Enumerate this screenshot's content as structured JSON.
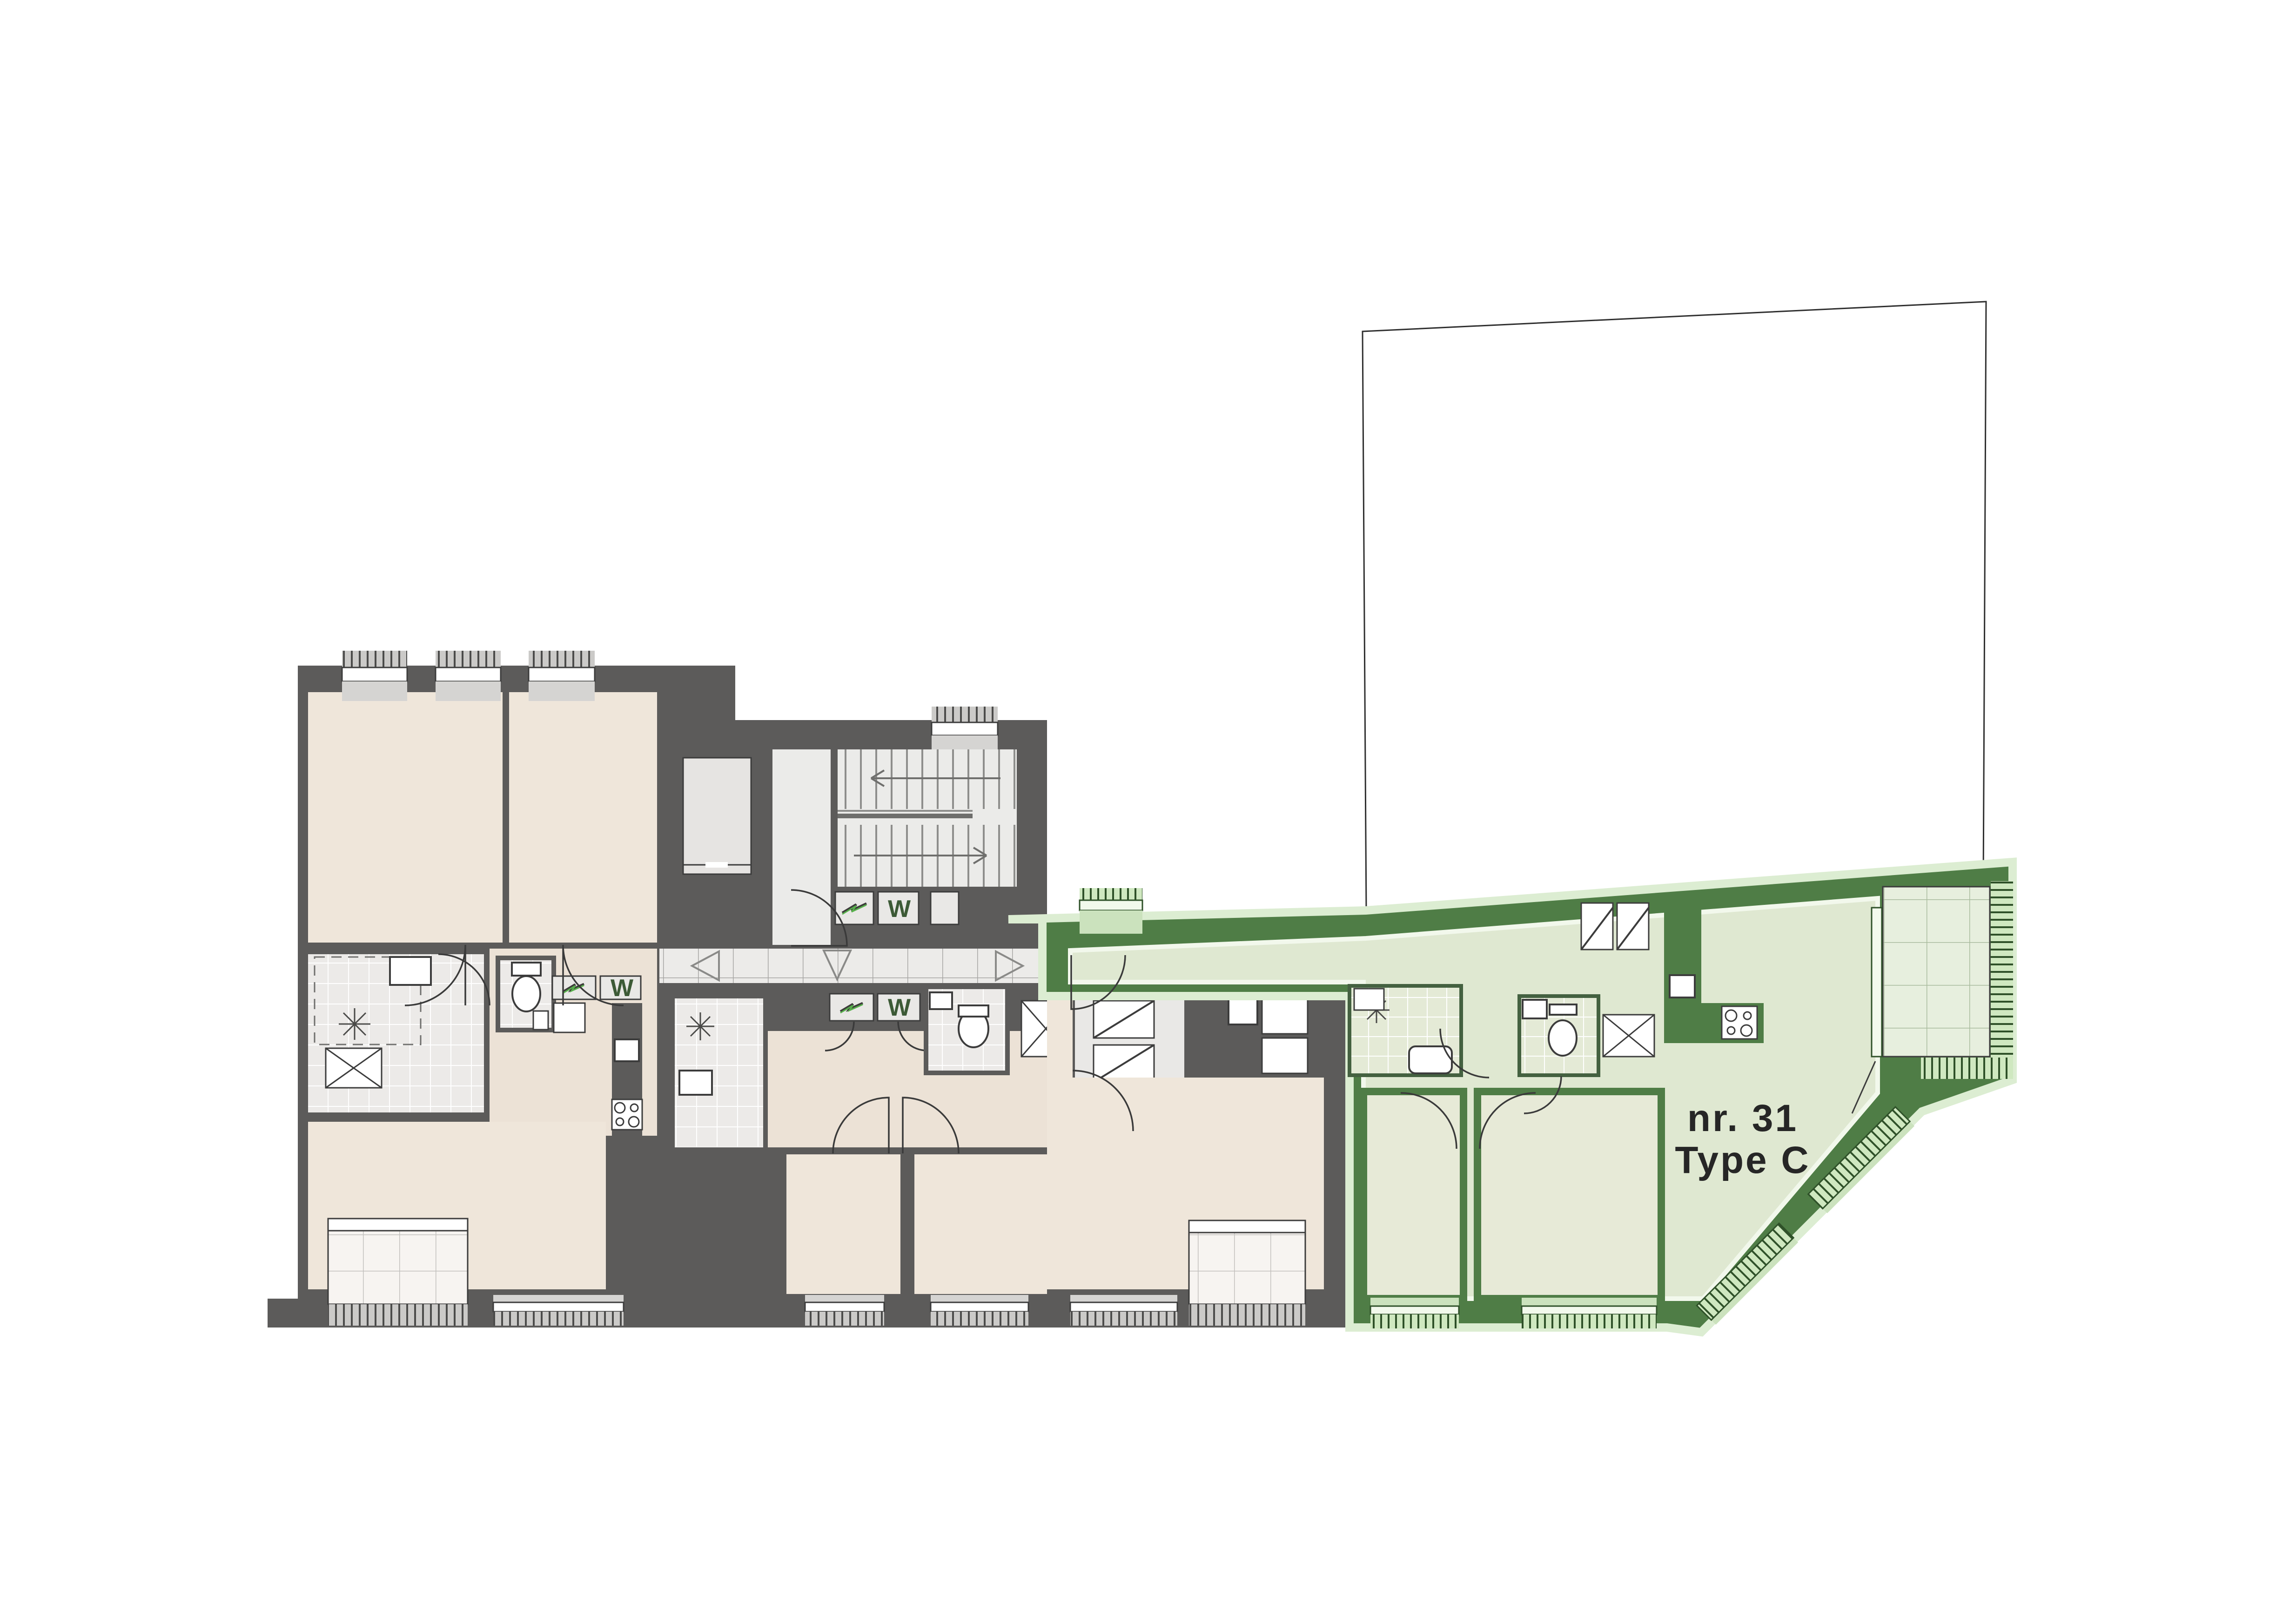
{
  "labels": {
    "apartment_number": "nr. 31",
    "apartment_type": "Type C"
  },
  "meters": {
    "water_label": "W",
    "electricity_icon": "lightning-zigzag"
  },
  "colors": {
    "wall": "#5c5b5a",
    "beige": "#efe6da",
    "beige2": "#ece2d6",
    "grayRoom": "#e9e8e6",
    "tile": "#ecebe9",
    "tileLine": "#a6a5a3",
    "bathTile": "#eceae8",
    "grout": "#ffffff",
    "sill": "#d5d4d2",
    "hatchBg": "#cbcac8",
    "hatchLine": "#4c4c4b",
    "stair": "#ebebe9",
    "tread": "#8e8e8c",
    "cab": "#e6e4e2",
    "greenWall": "#4f7d46",
    "greenFloor": "#dfe8d1",
    "greenFloor2": "#e7ead7",
    "greenBath": "#e4ead6",
    "greenSill": "#cbe2bd",
    "greenHatch": "#cfe8c0",
    "greenHatchLine": "#2f5129",
    "greenGlow": "#dcedd2",
    "terrace": "#e7efde",
    "terraceLine": "#a9bb9d",
    "balcony": "#f7f4f1",
    "balconyLine": "#c2c0bd",
    "ink": "#262626",
    "door": "#3a3a3a",
    "symbolGreen": "#58b14c"
  }
}
